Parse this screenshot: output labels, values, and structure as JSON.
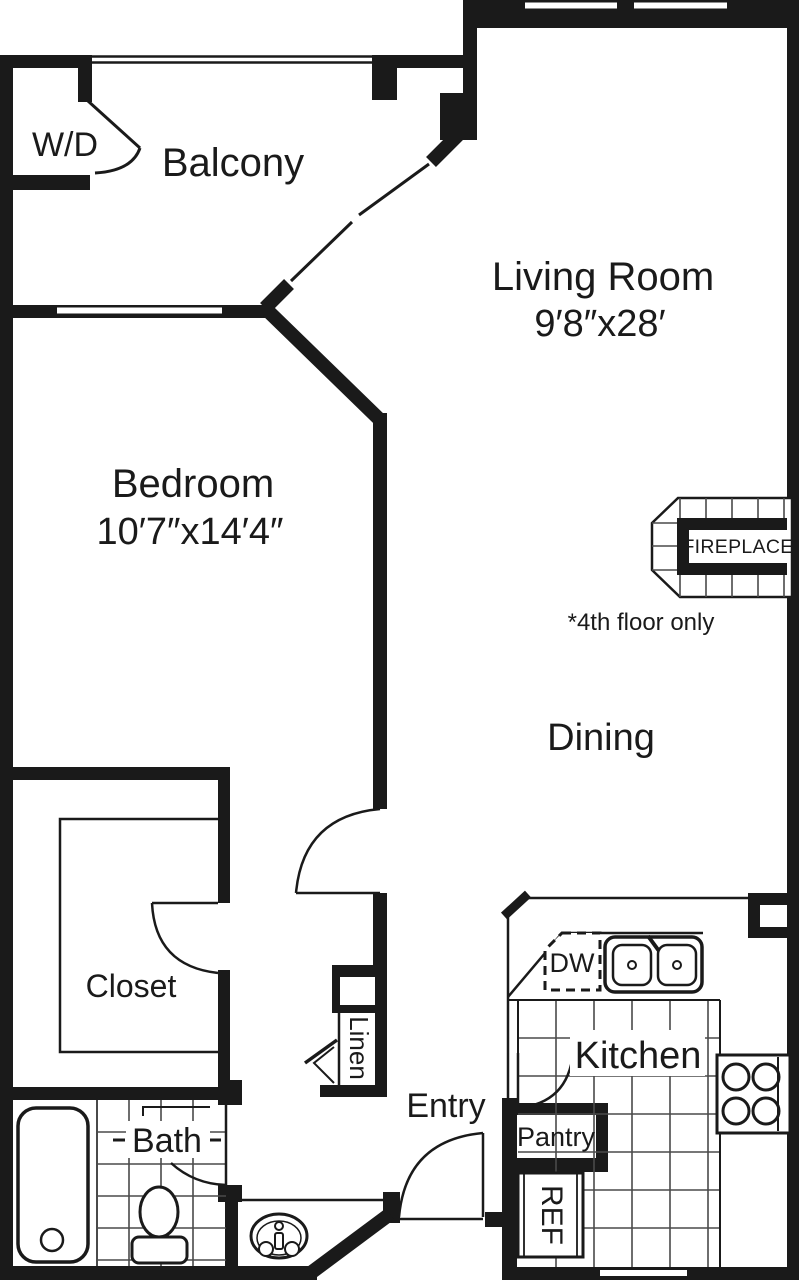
{
  "plan_title": "One-bedroom apartment floor plan",
  "colors": {
    "wall": "#1a1a1a",
    "tile": "#4a4a4a",
    "bg": "#ffffff"
  },
  "rooms": {
    "balcony": {
      "label": "Balcony"
    },
    "living_room": {
      "label": "Living Room",
      "dims": "9′8″x28′"
    },
    "bedroom": {
      "label": "Bedroom",
      "dims": "10′7″x14′4″"
    },
    "dining": {
      "label": "Dining"
    },
    "closet": {
      "label": "Closet"
    },
    "bath": {
      "label": "Bath"
    },
    "entry": {
      "label": "Entry"
    },
    "kitchen": {
      "label": "Kitchen"
    }
  },
  "storage": {
    "wd": {
      "label": "W/D"
    },
    "linen": {
      "label": "Linen"
    },
    "pantry": {
      "label": "Pantry"
    }
  },
  "fixtures": {
    "dw": {
      "label": "DW"
    },
    "ref": {
      "label": "REF"
    },
    "fireplace": {
      "label": "FIREPLACE",
      "note": "*4th floor only"
    }
  }
}
